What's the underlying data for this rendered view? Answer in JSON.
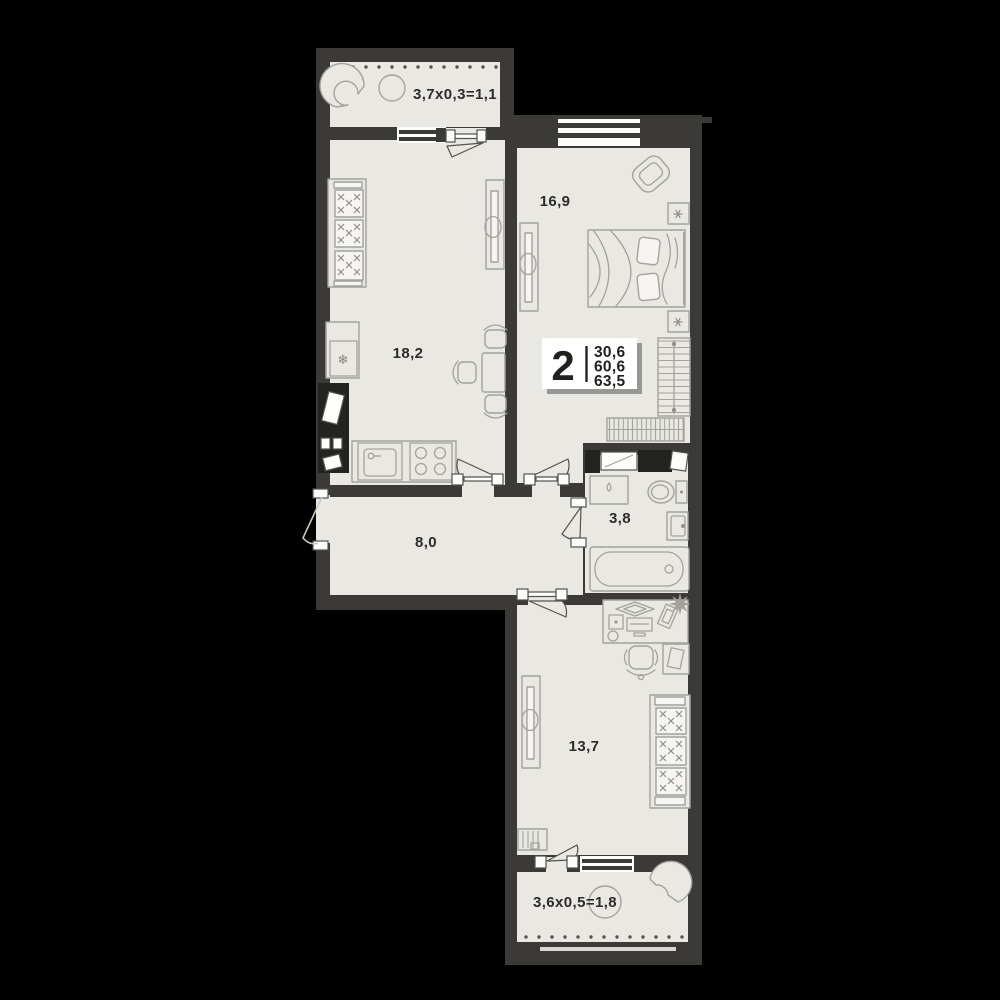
{
  "title": "2-room apartment floor plan",
  "badge": {
    "rooms": "2",
    "values": [
      "30,6",
      "60,6",
      "63,5"
    ]
  },
  "rooms": [
    {
      "id": "balcony-top",
      "label": "3,7x0,3=1,1"
    },
    {
      "id": "kitchen-living",
      "label": "18,2"
    },
    {
      "id": "bedroom",
      "label": "16,9"
    },
    {
      "id": "hallway",
      "label": "8,0"
    },
    {
      "id": "bathroom",
      "label": "3,8"
    },
    {
      "id": "bedroom-2",
      "label": "13,7"
    },
    {
      "id": "balcony-bottom",
      "label": "3,6x0,5=1,8"
    }
  ],
  "icons": {
    "snowflake": "❄"
  },
  "colors": {
    "bg": "#000000",
    "wall": "#3b3a36",
    "floor": "#e9e8e3",
    "line": "#a3a29c",
    "text": "#2d2c29",
    "shaft": "#23231f",
    "white": "#ffffff"
  }
}
